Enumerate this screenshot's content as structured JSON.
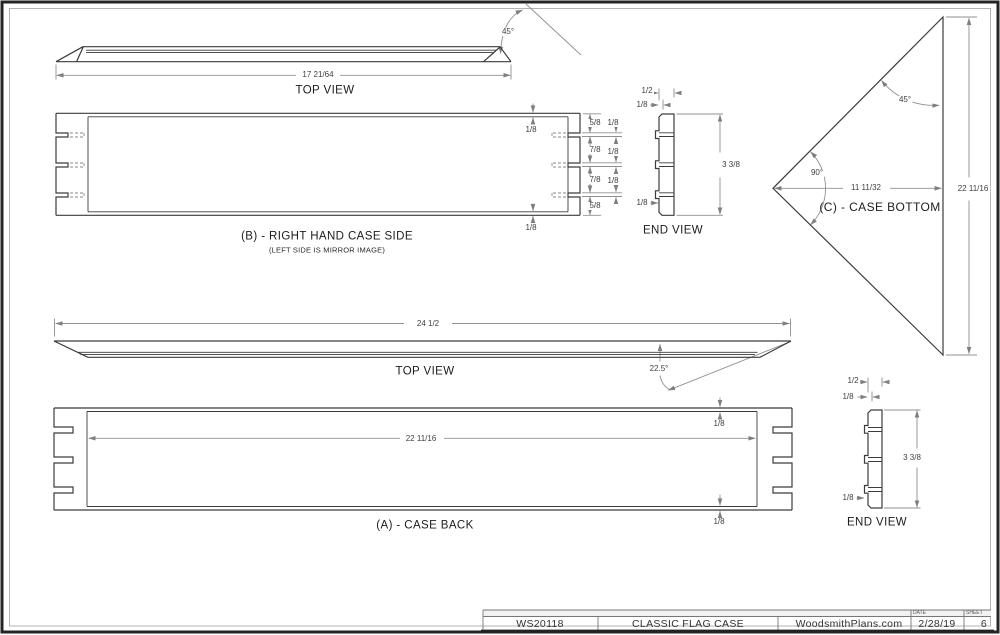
{
  "page": {
    "object_line_color": "#3c3c3c",
    "dim_line_color": "#909090"
  },
  "views": {
    "top_view_side": {
      "title": "TOP VIEW",
      "length": "17 21/64",
      "miter_angle": "45°"
    },
    "case_side": {
      "title": "(B) - RIGHT HAND CASE SIDE",
      "note": "(LEFT SIDE IS MIRROR IMAGE)",
      "top_edge": "1/8",
      "bottom_edge": "1/8",
      "segments": [
        "5/8",
        "7/8",
        "7/8",
        "5/8"
      ],
      "slot_widths": [
        "1/8",
        "1/8",
        "1/8"
      ]
    },
    "end_view_side": {
      "title": "END VIEW",
      "width": "1/2",
      "lip": "1/8",
      "height": "3 3/8",
      "bottom_lip": "1/8"
    },
    "case_bottom": {
      "title": "(C) - CASE BOTTOM",
      "miter_angle": "45°",
      "corner_angle": "90°",
      "depth": "11 11/32",
      "width": "22 11/16"
    },
    "top_view_back": {
      "title": "TOP VIEW",
      "length": "24 1/2",
      "bevel_angle": "22.5°"
    },
    "case_back": {
      "title": "(A) - CASE BACK",
      "top_edge": "1/8",
      "inner_length": "22 11/16",
      "bottom_edge": "1/8"
    },
    "end_view_back": {
      "title": "END VIEW",
      "width": "1/2",
      "lip": "1/8",
      "height": "3 3/8",
      "bottom_lip": "1/8"
    }
  },
  "title_block": {
    "code": "WS20118",
    "project": "CLASSIC FLAG CASE",
    "site": "WoodsmithPlans.com",
    "date_label": "DATE",
    "date": "2/28/19",
    "sheet_label": "SHEET",
    "sheet": "6"
  }
}
